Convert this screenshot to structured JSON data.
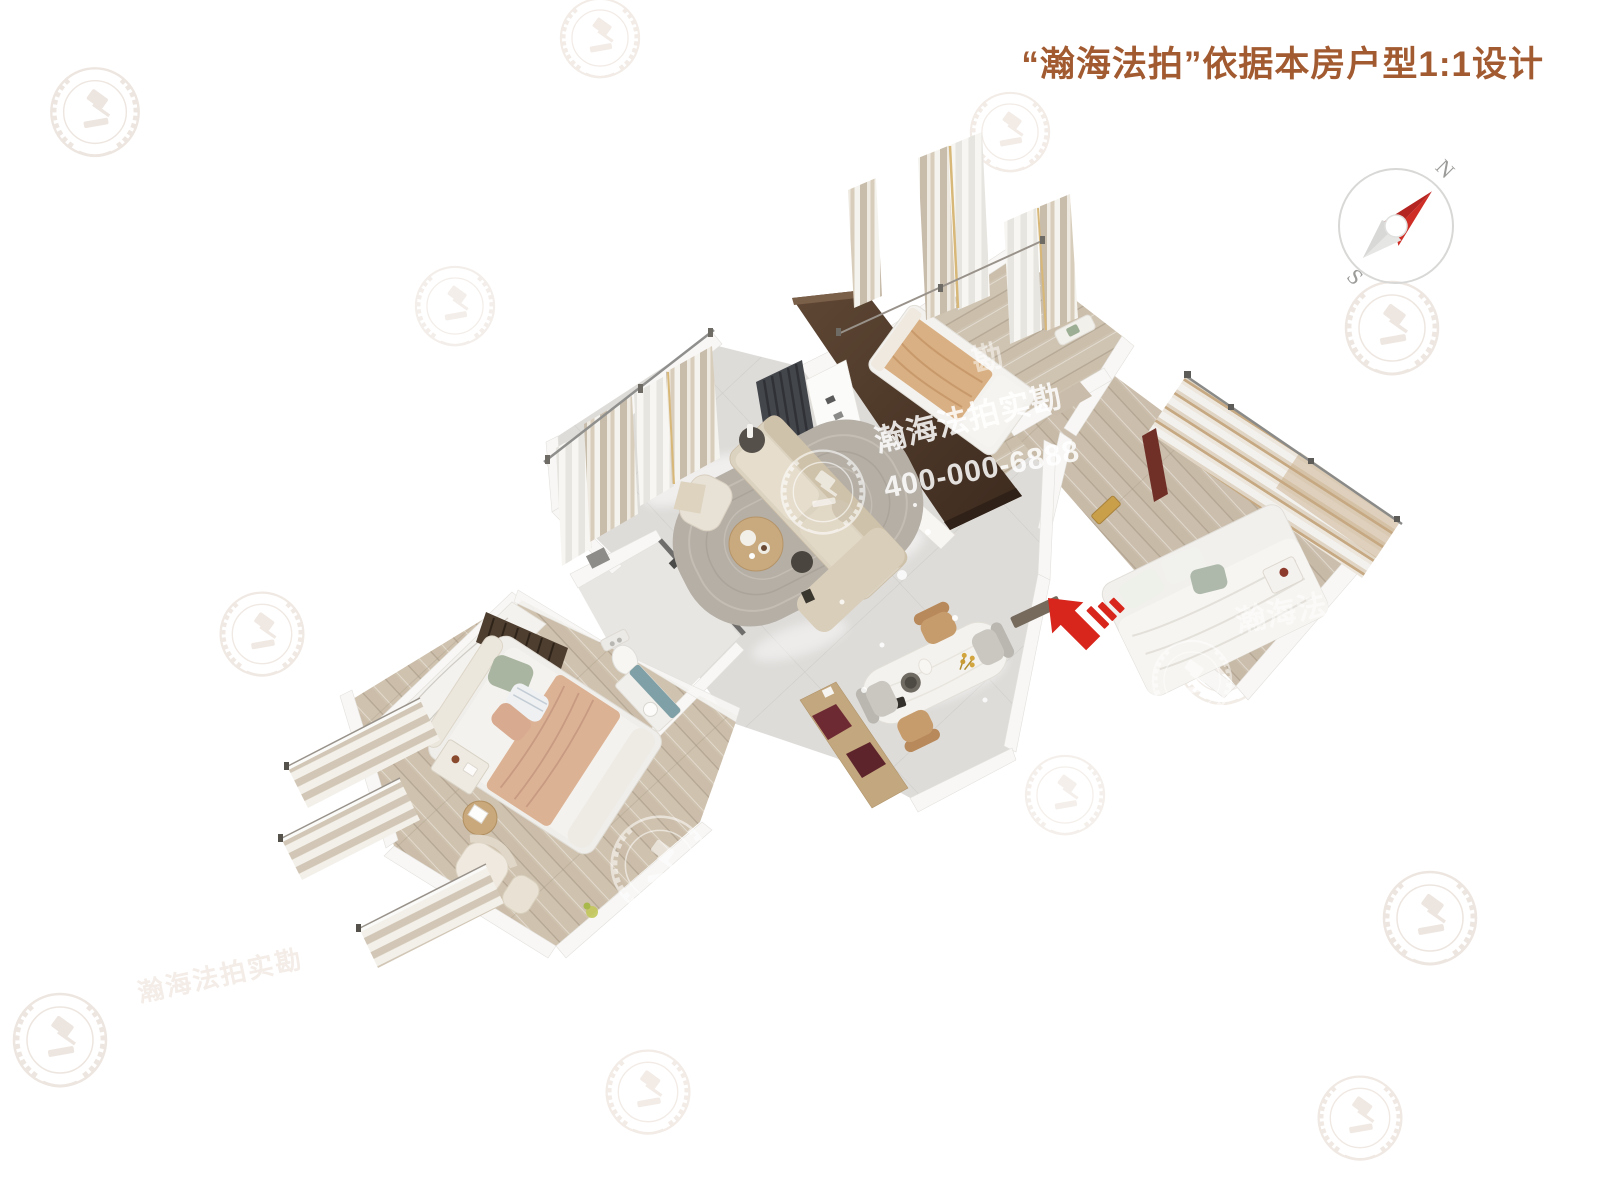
{
  "header": {
    "title": "“瀚海法拍”依据本房户型1:1设计",
    "title_color": "#a25a30"
  },
  "compass": {
    "north": "N",
    "south": "S",
    "needle_color": "#cd2e27",
    "ring_color": "#d8d8d6"
  },
  "watermark": {
    "brand": "瀚海法拍实勘",
    "phone": "400-000-6888",
    "fragment_right": "瀚海法",
    "fragment_top": "勘",
    "tile_text": "瀚海法拍实勘",
    "text_color": "#ffffff"
  },
  "entrance": {
    "arrow_color": "#d8261c"
  },
  "palette": {
    "wood_floor": "#cfc2ae",
    "marble_floor": "#dedcd9",
    "tv_panel_brown": "#4e382a",
    "curtain_beige": "#c8bcab",
    "vanity_teal": "#7fa0a6",
    "dining_chair_tan": "#c79c6d",
    "dining_chair_gray": "#c9c7c0"
  }
}
